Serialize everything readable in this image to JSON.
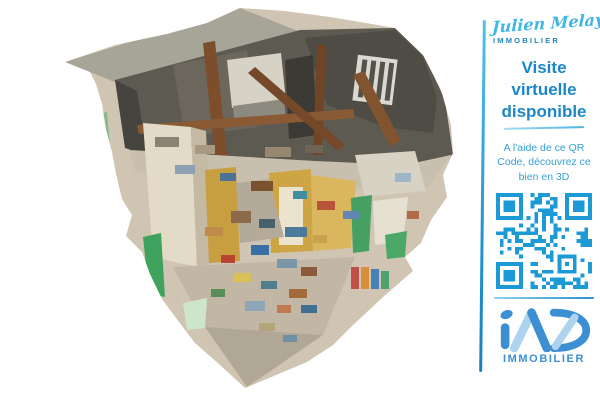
{
  "sidebar": {
    "agent": {
      "signature": "Julien Melay",
      "label": "IMMOBILIER"
    },
    "headline": "Visite virtuelle disponible",
    "description": "A l'aide de ce QR Code, découvrez ce bien en 3D",
    "qr": {
      "color": "#1b9ad6"
    },
    "brand": {
      "label": "IMMOBILIER",
      "color_primary": "#3d8fd4",
      "color_light": "#aed3ee"
    },
    "colors": {
      "accent_line": "#2196d3",
      "signature": "#3fb6e3",
      "agent_label": "#1f85c0",
      "headline": "#1b87c9",
      "description": "#35a0d6"
    }
  }
}
